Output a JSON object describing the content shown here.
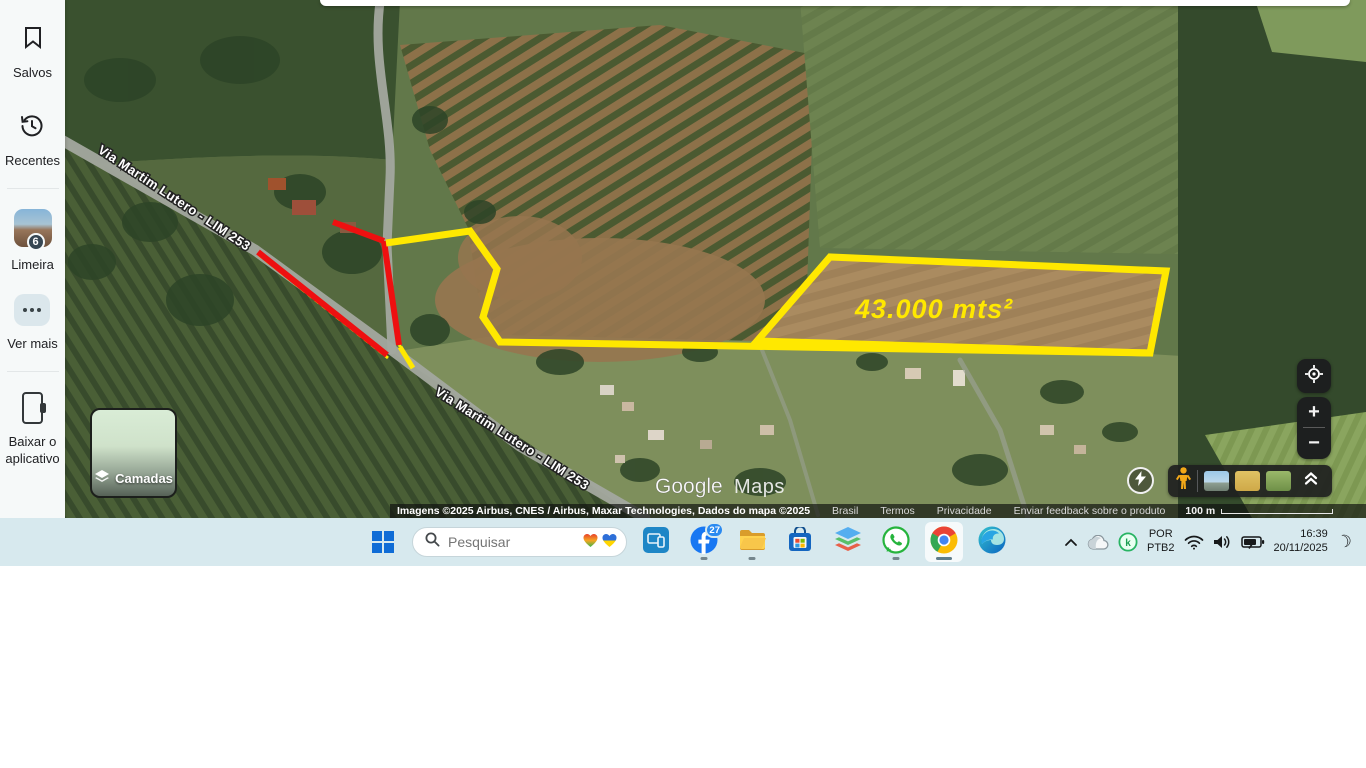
{
  "sidebar": {
    "items": [
      {
        "id": "saved",
        "label": "Salvos"
      },
      {
        "id": "recents",
        "label": "Recentes"
      },
      {
        "id": "limeira",
        "label": "Limeira",
        "badge": "6"
      },
      {
        "id": "more",
        "label": "Ver mais"
      },
      {
        "id": "app",
        "label_line1": "Baixar o",
        "label_line2": "aplicativo"
      }
    ]
  },
  "map": {
    "road_label": "Via Martim Lutero - LIM 253",
    "area_label": "43.000  mts²",
    "watermark": {
      "google": "Google",
      "maps": "Maps"
    },
    "layers_button_label": "Camadas",
    "controls": {
      "zoom_in": "+",
      "zoom_out": "−"
    },
    "attribution": {
      "imagery": "Imagens ©2025 Airbus, CNES / Airbus, Maxar Technologies, Dados do mapa ©2025",
      "link_brasil": "Brasil",
      "link_termos": "Termos",
      "link_privacidade": "Privacidade",
      "link_feedback": "Enviar feedback sobre o produto",
      "scale_label": "100 m"
    },
    "colors": {
      "annotation_yellow": "#ffe800",
      "annotation_red": "#ee1010"
    }
  },
  "taskbar": {
    "search": {
      "placeholder": "Pesquisar"
    },
    "facebook_badge": "27",
    "tray": {
      "lang_top": "POR",
      "lang_bottom": "PTB2",
      "time": "16:39",
      "date": "20/11/2025"
    }
  }
}
